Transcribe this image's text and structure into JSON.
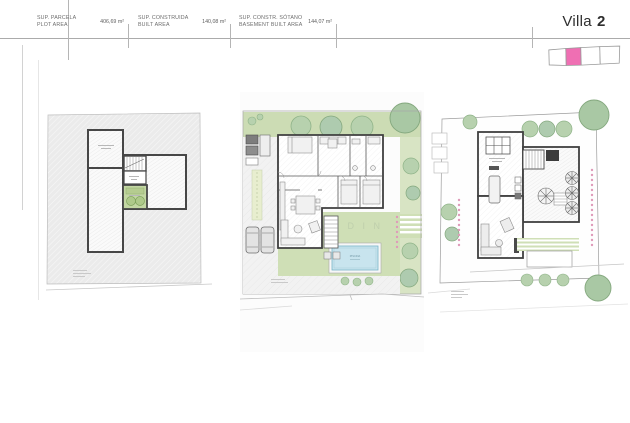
{
  "sheet": {
    "title_prefix": "Villa",
    "title_number": "2"
  },
  "header": {
    "areas": [
      {
        "label1": "SUP. PARCELA",
        "label2": "PLOT AREA",
        "value": "406,69 m²"
      },
      {
        "label1": "SUP. CONSTRUIDA",
        "label2": "BUILT AREA",
        "value": "140,08 m²"
      },
      {
        "label1": "SUP. CONSTR. SÓTANO",
        "label2": "BASEMENT BUILT AREA",
        "value": "144,07 m²"
      }
    ]
  },
  "keyplan": {
    "total_units": 4,
    "highlighted_unit": 2,
    "highlight_color": "#ef6fb3"
  },
  "plans": {
    "roof": {
      "description": "roof plan with solarium terrace"
    },
    "ground": {
      "pool_label": "PISCINA",
      "garden_watermark": "J A R D I N"
    },
    "basement": {
      "description": "basement / terrace plan"
    }
  },
  "colors": {
    "accent_pink": "#ef6fb3",
    "garden_green": "#cfdfb6",
    "pool_blue": "#c8e4ee",
    "wall_gray": "#474747",
    "hedge_dot_pink": "#df9bb9"
  }
}
